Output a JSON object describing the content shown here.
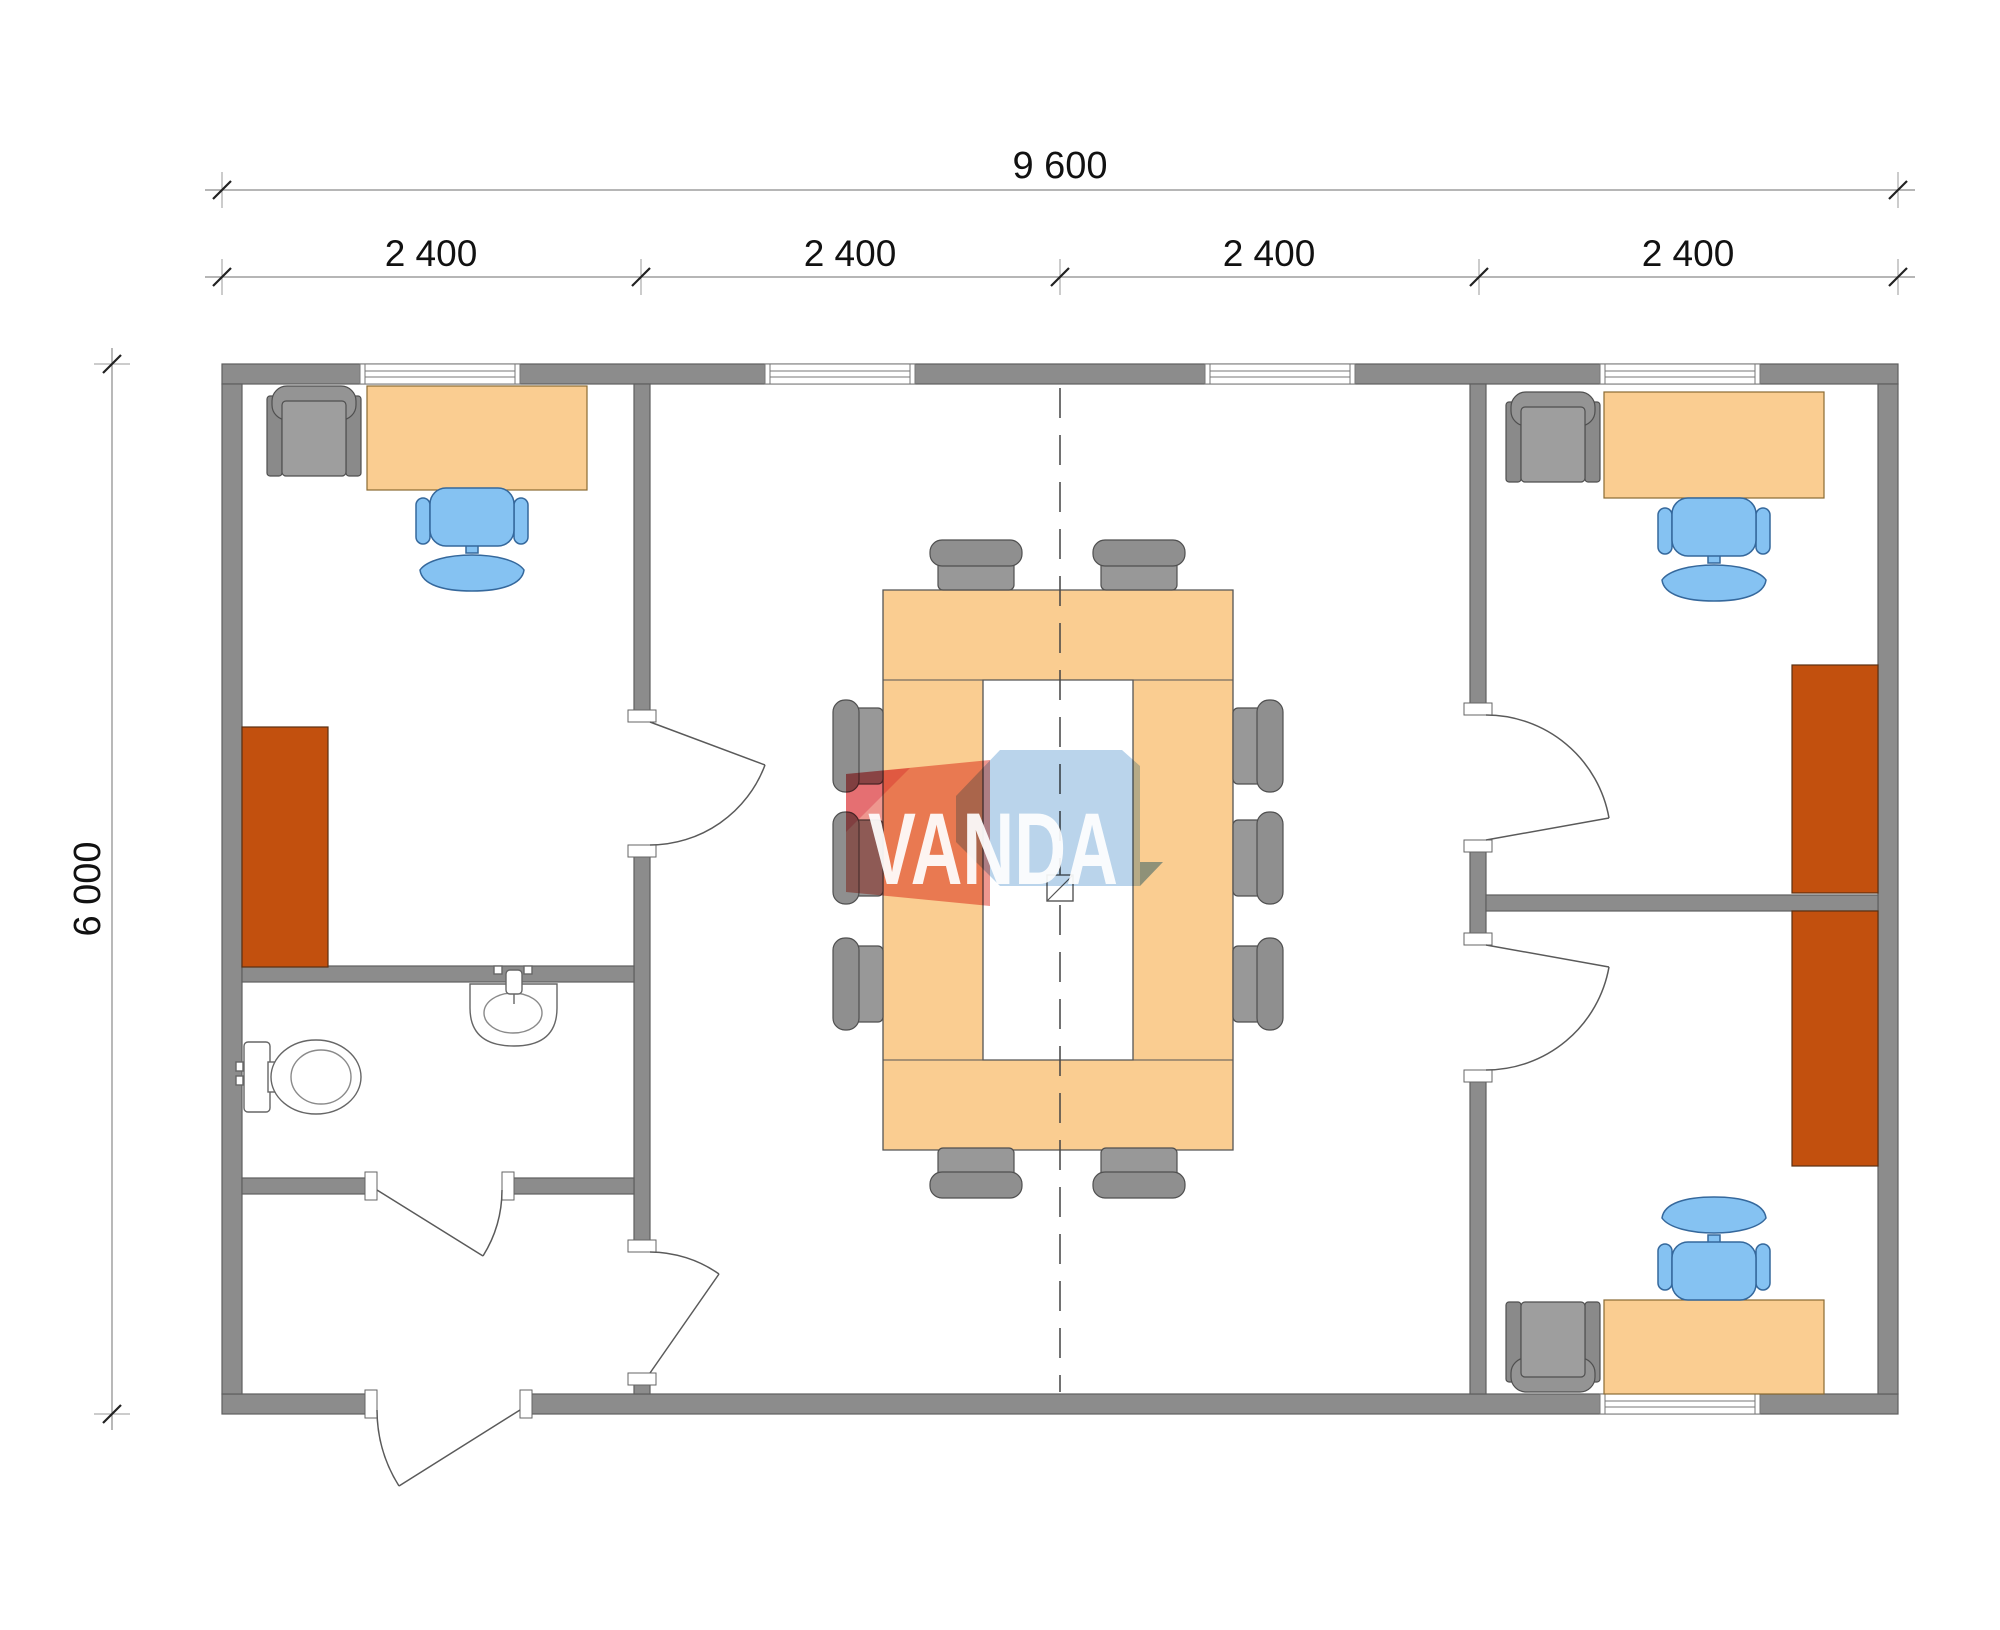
{
  "drawing": {
    "type": "modular-office-floor-plan",
    "watermark": {
      "text": "VANDA"
    },
    "dimensions": {
      "total_width_label": "9 600",
      "total_height_label": "6 000",
      "module_labels": [
        "2 400",
        "2 400",
        "2 400",
        "2 400"
      ]
    },
    "colors": {
      "wall": "#8C8C8C",
      "wall_stroke": "#5F5F5F",
      "desk": "#FACD91",
      "table": "#FACD91",
      "cabinet": "#C2500E",
      "chair_blue": "#85C2F2",
      "chair_blue_stroke": "#35689C",
      "chair_gray_seat": "#9E9E9E",
      "chair_gray_back": "#949494",
      "chair_gray_arm": "#8A8A8A",
      "conf_chair_seat": "#989898",
      "conf_chair_back": "#8F8F8F",
      "logo_red": "#E4574A",
      "logo_pink": "#F2A0B5",
      "logo_blue": "#9FC3E4",
      "logo_blue_dark": "#7FA8CC",
      "logo_text": "#FFFFFF",
      "dim_text": "#111111"
    },
    "inventory": {
      "offices": 3,
      "desks": 3,
      "desk_chairs": 3,
      "guest_armchairs": 3,
      "cabinets": 3,
      "conference_tables": 1,
      "conference_chairs": 10,
      "toilets": 1,
      "sinks": 1,
      "windows": 5,
      "doors": 6
    }
  }
}
